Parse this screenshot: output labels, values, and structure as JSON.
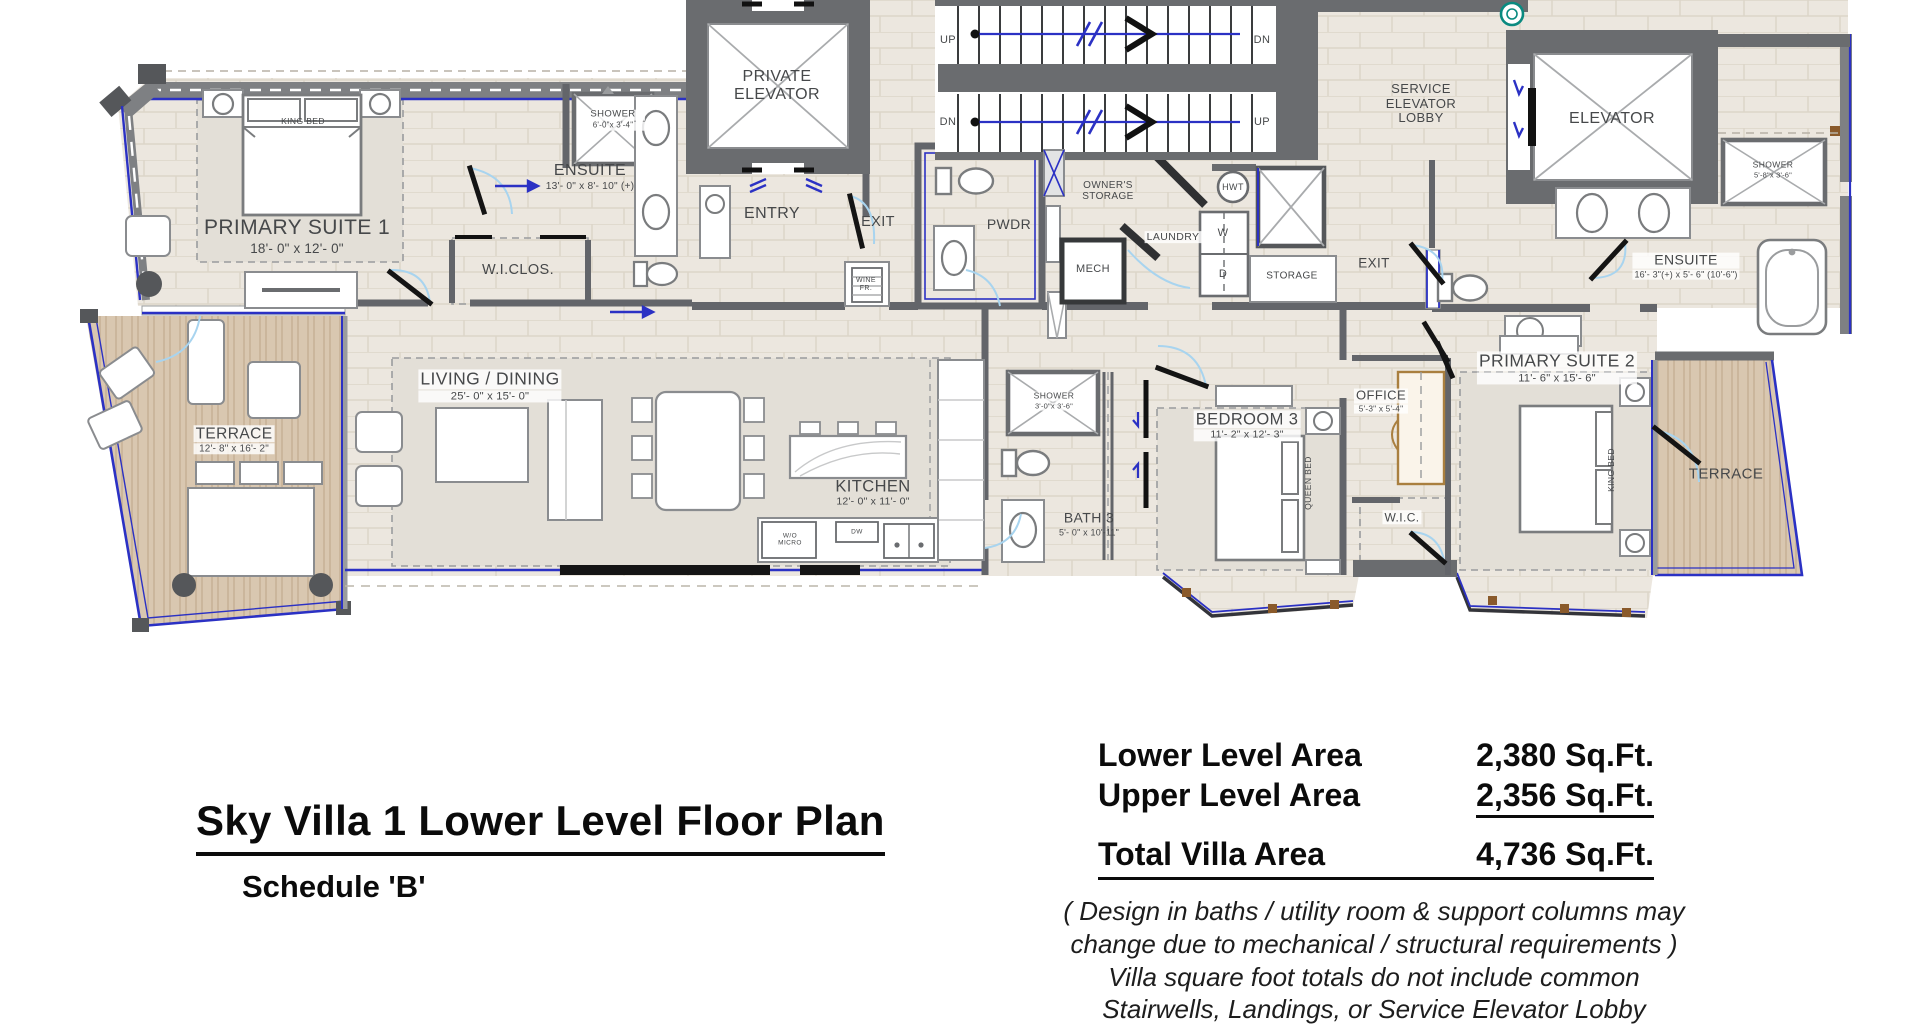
{
  "title": {
    "main": "Sky Villa 1 Lower Level Floor Plan",
    "schedule": "Schedule  'B'"
  },
  "area_table": {
    "rows": [
      {
        "label": "Lower Level Area",
        "value": "2,380 Sq.Ft."
      },
      {
        "label": "Upper Level Area",
        "value": "2,356 Sq.Ft."
      },
      {
        "label": "Total Villa Area",
        "value": "4,736 Sq.Ft."
      }
    ]
  },
  "disclaimer": {
    "line1": "(  Design in baths / utility room & support columns may",
    "line2": "change due to mechanical / structural requirements )",
    "line3": "Villa square foot totals do not include common",
    "line4": "Stairwells, Landings, or Service Elevator Lobby"
  },
  "rooms": {
    "primary_suite_1": {
      "name": "PRIMARY SUITE 1",
      "dims": "18'- 0\" x 12'- 0\""
    },
    "ensuite_1": {
      "name": "ENSUITE",
      "dims": "13'- 0\" x 8'- 10\" (+)"
    },
    "shower_1": {
      "name": "SHOWER",
      "dims": "6'-0\"x 3'-4\""
    },
    "wiclos": {
      "name": "W.I.CLOS."
    },
    "private_elevator": {
      "name": "PRIVATE ELEVATOR"
    },
    "entry": {
      "name": "ENTRY"
    },
    "exit_left": {
      "name": "EXIT"
    },
    "pwdr": {
      "name": "PWDR"
    },
    "owners_storage": {
      "name": "OWNER'S STORAGE"
    },
    "mech": {
      "name": "MECH"
    },
    "laundry": {
      "name": "LAUNDRY"
    },
    "storage": {
      "name": "STORAGE"
    },
    "service_lobby": {
      "name": "SERVICE ELEVATOR LOBBY"
    },
    "elevator": {
      "name": "ELEVATOR"
    },
    "shower_tr": {
      "name": "SHOWER",
      "dims": "5'-8\"x 3'-6\""
    },
    "exit_right": {
      "name": "EXIT"
    },
    "ensuite_2": {
      "name": "ENSUITE",
      "dims": "16'- 3\"(+) x 5'- 6\" (10'-6\")"
    },
    "primary_suite_2": {
      "name": "PRIMARY SUITE 2",
      "dims": "11'- 6\" x 15'- 6\""
    },
    "terrace_right": {
      "name": "TERRACE"
    },
    "office": {
      "name": "OFFICE",
      "dims": "5'-3\" x 5'-4\""
    },
    "wic2": {
      "name": "W.I.C."
    },
    "bedroom_3": {
      "name": "BEDROOM 3",
      "dims": "11'- 2\" x 12'- 3\""
    },
    "bath_3": {
      "name": "BATH 3",
      "dims": "5'- 0\" x 10'-11\""
    },
    "shower_3": {
      "name": "SHOWER",
      "dims": "3'-0\"x 3'-6\""
    },
    "kitchen": {
      "name": "KITCHEN",
      "dims": "12'- 0\" x 11'- 0\""
    },
    "living_dining": {
      "name": "LIVING / DINING",
      "dims": "25'- 0\" x 15'- 0\""
    },
    "terrace_left": {
      "name": "TERRACE",
      "dims": "12'- 8\" x 16'- 2\""
    }
  },
  "labels": {
    "king_bed": "KING BED",
    "queen_bed": "QUEEN BED",
    "up": "UP",
    "dn": "DN",
    "hwt": "HWT",
    "washer": "W",
    "dryer": "D",
    "wine_fr": "WINE FR.",
    "wo_micro": "W/O MICRO",
    "dw": "DW"
  },
  "colors": {
    "window_blue": "#2b31c4",
    "wall_gray": "#63656a",
    "wood_tan": "#d9c7b0",
    "door_black": "#141414",
    "teal_accent": "#0a8a80",
    "floor_beige": "#ece7df"
  }
}
